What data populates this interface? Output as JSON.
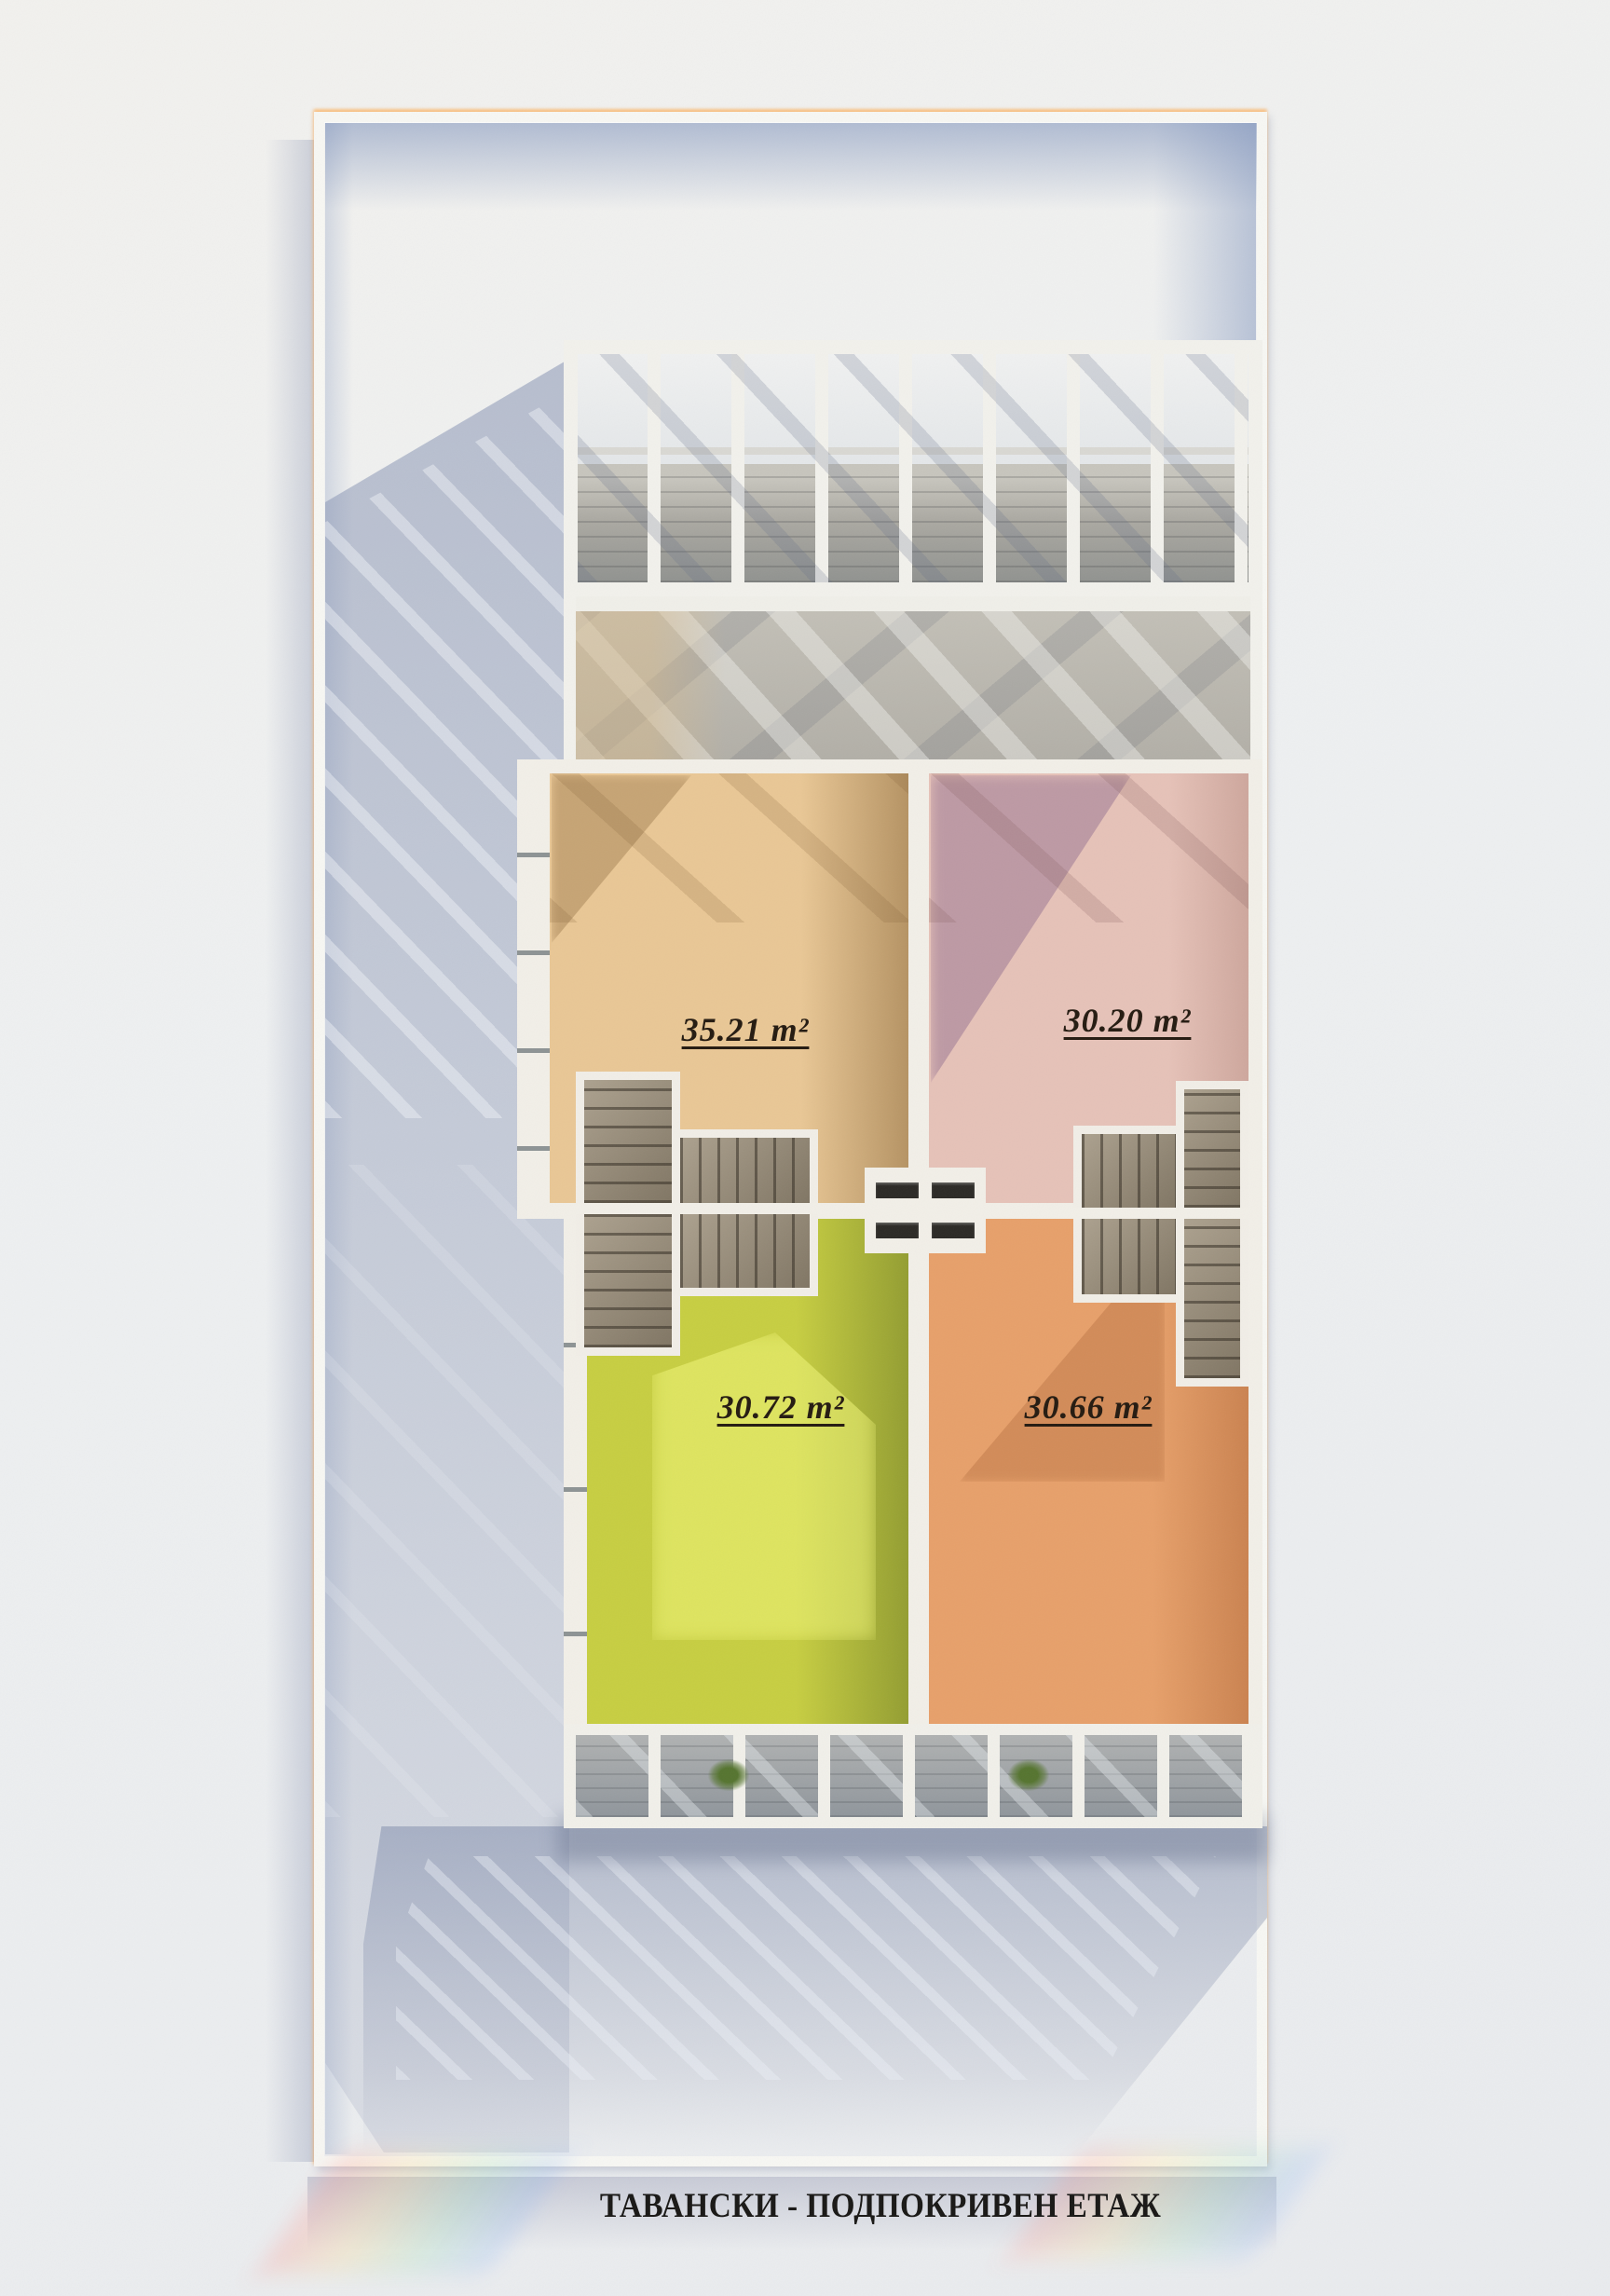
{
  "plan": {
    "title": "ТАВАНСКИ - ПОДПОКРИВЕН ЕТАЖ",
    "units": [
      {
        "position": "top-left",
        "area": "35.21 m²",
        "floor_color": "#e9c795"
      },
      {
        "position": "top-right",
        "area": "30.20 m²",
        "floor_color": "#e6c2b8"
      },
      {
        "position": "bottom-left",
        "area": "30.72 m²",
        "floor_color": "#c7ce41"
      },
      {
        "position": "bottom-right",
        "area": "30.66 m²",
        "floor_color": "#e7a06a"
      }
    ],
    "palette": {
      "background": "#eef0f1",
      "walls": "#f2efe8",
      "frame": "#f7f7f3",
      "stair_wood": "#9c8f79",
      "shadow_blue": "#8c9cba",
      "terrace_floor": "#aaa8a1",
      "label_text": "#241a10"
    }
  }
}
